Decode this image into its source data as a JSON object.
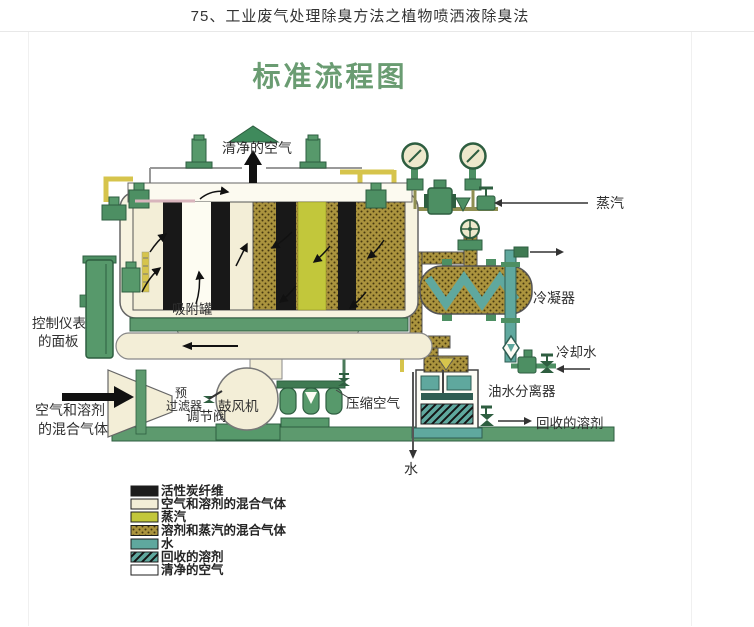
{
  "page": {
    "title": "75、工业废气处理除臭方法之植物喷洒液除臭法"
  },
  "diagram": {
    "title": "标准流程图",
    "labels": {
      "clean_air": "清净的空气",
      "steam": "蒸汽",
      "condenser": "冷凝器",
      "cooling_water": "冷却水",
      "oil_water_separator": "油水分离器",
      "recovered_solvent": "回收的溶剂",
      "water": "水",
      "compressed_air": "压缩空气",
      "blower": "鼓风机",
      "regulating_valve": "调节阀",
      "pre_filter_line1": "预",
      "pre_filter_line2": "过滤器",
      "adsorption_tank": "吸附罐",
      "control_panel_line1": "控制仪表",
      "control_panel_line2": "的面板",
      "inlet_gas_line1": "空气和溶剂",
      "inlet_gas_line2": "的混合气体"
    },
    "colors": {
      "component_green": "#57996b",
      "dark_green": "#2e5e40",
      "chevron_green": "#3f8a5c",
      "cream": "#f3eed7",
      "steam_yellow": "#c2c73b",
      "khaki_pattern": "#ab943e",
      "teal": "#5fa89e",
      "floor_green": "#5d9a6e",
      "pipe_yellow": "#d6c44c",
      "title_green": "#6a9c72",
      "black": "#181818"
    }
  },
  "legend": {
    "items": [
      {
        "label": "活性炭纤维",
        "color": "#1c1c1c",
        "pattern": "solid"
      },
      {
        "label": "空气和溶剂的混合气体",
        "color": "#f3eed7",
        "pattern": "solid"
      },
      {
        "label": "蒸汽",
        "color": "#c2c73b",
        "pattern": "solid"
      },
      {
        "label": "溶剂和蒸汽的混合气体",
        "color": "#ab943e",
        "pattern": "speckle"
      },
      {
        "label": "水",
        "color": "#5fa89e",
        "pattern": "solid"
      },
      {
        "label": "回收的溶剂",
        "color": "#5fa89e",
        "pattern": "diagonal-hatch"
      },
      {
        "label": "清净的空气",
        "color": "#ffffff",
        "pattern": "solid"
      }
    ]
  }
}
